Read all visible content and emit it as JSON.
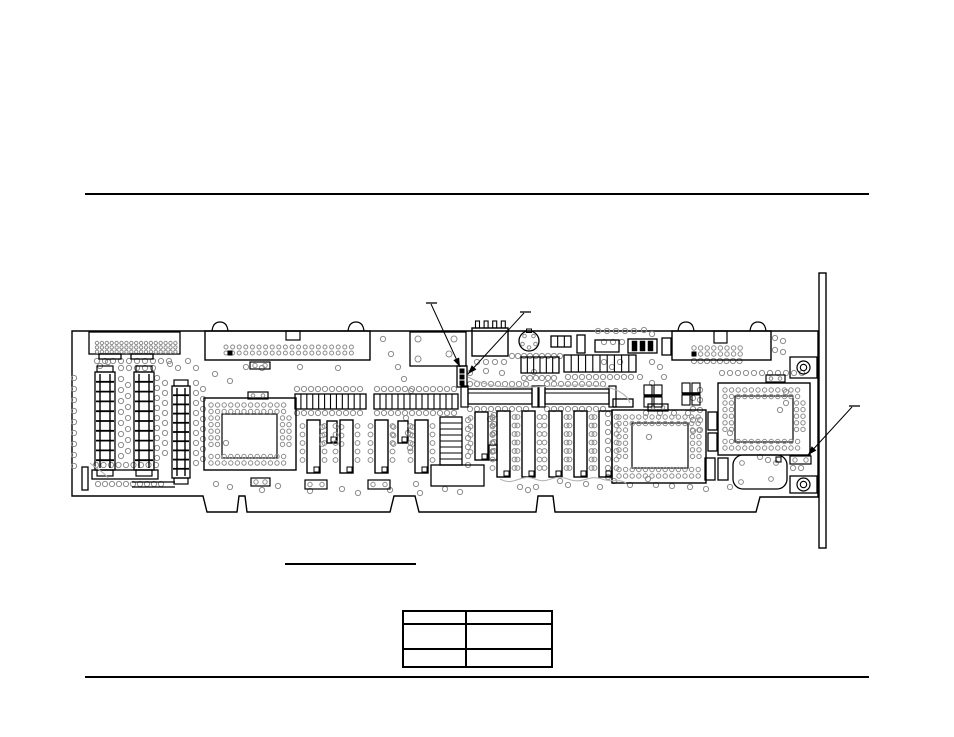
{
  "document": {
    "background": "#ffffff",
    "ink": "#000000",
    "pad_color": "#8c8c8c",
    "arc_color": "#b5b5b5"
  },
  "table": {
    "rows": [
      [
        "",
        ""
      ],
      [
        "",
        ""
      ],
      [
        "",
        ""
      ]
    ]
  },
  "board": {
    "outline": "M72,331 L818,331 L818,497 L760,497 L756,512 L555,512 L553,496 L538,496 L536,512 L419,512 L415,496 L394,496 L390,512 L247,512 L245,496 L239,496 L237,512 L207,512 L203,496 L72,496 Z",
    "bracket": {
      "x": 819,
      "y": 273,
      "w": 7,
      "h": 275
    },
    "components": [
      {
        "t": "rect",
        "n": "edge-connector-left",
        "x": 89,
        "y": 332,
        "w": 91,
        "h": 22
      },
      {
        "t": "grid",
        "n": "edge-connector-left-pins",
        "x": 97,
        "y": 343,
        "cols": 17,
        "rows": 3,
        "dx": 4.9,
        "dy": 4.4,
        "r": 1.7
      },
      {
        "t": "rect",
        "n": "connector-tab",
        "x": 99,
        "y": 354,
        "w": 22,
        "h": 5
      },
      {
        "t": "rect",
        "n": "connector-tab",
        "x": 131,
        "y": 354,
        "w": 22,
        "h": 5
      },
      {
        "t": "header",
        "n": "floppy-header-connector",
        "x": 205,
        "y": 331,
        "w": 165,
        "h": 29,
        "notch": [
          286,
          331,
          14,
          9
        ],
        "ears": [
          212,
          348
        ],
        "pins": [
          226,
          347,
          20,
          2,
          6.6,
          6,
          2
        ]
      },
      {
        "t": "rect",
        "n": "relay-component",
        "x": 410,
        "y": 332,
        "w": 56,
        "h": 34
      },
      {
        "t": "dots",
        "n": "relay-pads",
        "r": 3,
        "pts": [
          [
            418,
            339
          ],
          [
            454,
            339
          ],
          [
            418,
            359
          ],
          [
            449,
            354
          ]
        ]
      },
      {
        "t": "power",
        "n": "power-connector",
        "x": 472,
        "y": 328,
        "w": 36,
        "h": 28
      },
      {
        "t": "din",
        "n": "keyboard-din-connector",
        "cx": 529,
        "cy": 341,
        "r": 10
      },
      {
        "t": "header",
        "n": "aux-header-connector",
        "x": 672,
        "y": 331,
        "w": 99,
        "h": 29,
        "notch": [
          714,
          331,
          13,
          12
        ],
        "ears": [
          678,
          750
        ],
        "pins": [
          694,
          348,
          8,
          2,
          6.6,
          6,
          2.2
        ]
      },
      {
        "t": "mount",
        "n": "mounting-hole-top",
        "x": 790,
        "y": 357,
        "w": 27,
        "h": 21
      },
      {
        "t": "mount",
        "n": "mounting-hole-bottom",
        "x": 790,
        "y": 476,
        "w": 27,
        "h": 17
      },
      {
        "t": "simmv",
        "n": "memory-socket-1",
        "x": 95,
        "y": 372,
        "w": 20,
        "h": 98,
        "rungs": 9
      },
      {
        "t": "simmv",
        "n": "memory-socket-2",
        "x": 134,
        "y": 372,
        "w": 20,
        "h": 98,
        "rungs": 9
      },
      {
        "t": "simmv",
        "n": "memory-socket-3",
        "x": 172,
        "y": 386,
        "w": 18,
        "h": 92,
        "rungs": 9
      },
      {
        "t": "rect",
        "n": "bottom-left-connector",
        "x": 92,
        "y": 470,
        "w": 66,
        "h": 9
      },
      {
        "t": "rect",
        "n": "small-ic",
        "x": 82,
        "y": 467,
        "w": 6,
        "h": 23
      },
      {
        "t": "line",
        "n": "silkscreen-line",
        "p": [
          132,
          482,
          175,
          482
        ]
      },
      {
        "t": "line",
        "n": "silkscreen-line",
        "p": [
          132,
          487,
          175,
          487
        ]
      },
      {
        "t": "pga",
        "n": "pga-chip-left",
        "x": 204,
        "y": 398,
        "w": 92,
        "h": 72,
        "inner": [
          222,
          414,
          55,
          44
        ],
        "cap": [
          248,
          392,
          20,
          7
        ]
      },
      {
        "t": "comb",
        "n": "resistor-pack",
        "x": 295,
        "y": 394,
        "w": 71,
        "h": 15,
        "bars": 11
      },
      {
        "t": "comb",
        "n": "resistor-pack",
        "x": 374,
        "y": 394,
        "w": 84,
        "h": 15,
        "bars": 13
      },
      {
        "t": "dip",
        "n": "dip-chip",
        "x": 307,
        "y": 420,
        "w": 13,
        "h": 53
      },
      {
        "t": "dip",
        "n": "dip-chip-small",
        "x": 327,
        "y": 421,
        "w": 10,
        "h": 22
      },
      {
        "t": "dip",
        "n": "dip-chip",
        "x": 340,
        "y": 420,
        "w": 13,
        "h": 53
      },
      {
        "t": "dip",
        "n": "dip-chip",
        "x": 375,
        "y": 420,
        "w": 13,
        "h": 53
      },
      {
        "t": "dip",
        "n": "dip-chip-small",
        "x": 398,
        "y": 421,
        "w": 10,
        "h": 22
      },
      {
        "t": "dip",
        "n": "dip-chip",
        "x": 415,
        "y": 420,
        "w": 13,
        "h": 53
      },
      {
        "t": "sip",
        "n": "sip-resistor-network",
        "x": 440,
        "y": 417,
        "w": 22,
        "h": 48,
        "rungs": 7
      },
      {
        "t": "dip",
        "n": "dip-chip",
        "x": 475,
        "y": 412,
        "w": 13,
        "h": 48
      },
      {
        "t": "rect",
        "n": "small-ic",
        "x": 489,
        "y": 445,
        "w": 8,
        "h": 15
      },
      {
        "t": "rect",
        "n": "crystal-oscillator",
        "x": 431,
        "y": 465,
        "w": 53,
        "h": 21
      },
      {
        "t": "pads2",
        "n": "jumper-pads",
        "x": 251,
        "y": 478,
        "w": 19,
        "h": 8
      },
      {
        "t": "pads2",
        "n": "jumper-pads",
        "x": 250,
        "y": 362,
        "w": 20,
        "h": 7
      },
      {
        "t": "pads2",
        "n": "jumper-pads",
        "x": 305,
        "y": 480,
        "w": 22,
        "h": 9
      },
      {
        "t": "pads2",
        "n": "jumper-pads",
        "x": 368,
        "y": 480,
        "w": 22,
        "h": 9
      },
      {
        "t": "jumper3",
        "n": "config-jumper",
        "x": 457,
        "y": 366,
        "w": 10,
        "h": 21
      },
      {
        "t": "simmh",
        "n": "sipp-socket-1",
        "x": 468,
        "y": 389,
        "w": 64,
        "h": 15
      },
      {
        "t": "simmh",
        "n": "sipp-socket-2",
        "x": 545,
        "y": 389,
        "w": 64,
        "h": 15
      },
      {
        "t": "dip",
        "n": "dram-chip",
        "x": 497,
        "y": 411,
        "w": 13,
        "h": 66
      },
      {
        "t": "dip",
        "n": "dram-chip",
        "x": 522,
        "y": 411,
        "w": 13,
        "h": 66
      },
      {
        "t": "dip",
        "n": "dram-chip",
        "x": 549,
        "y": 411,
        "w": 13,
        "h": 66
      },
      {
        "t": "dip",
        "n": "dram-chip",
        "x": 574,
        "y": 411,
        "w": 13,
        "h": 66
      },
      {
        "t": "dip",
        "n": "dram-chip",
        "x": 599,
        "y": 411,
        "w": 13,
        "h": 66
      },
      {
        "t": "rect",
        "n": "small-ic",
        "x": 613,
        "y": 399,
        "w": 20,
        "h": 8
      },
      {
        "t": "pga",
        "n": "pga-chip-center",
        "x": 612,
        "y": 410,
        "w": 94,
        "h": 73,
        "inner": [
          632,
          423,
          56,
          45
        ],
        "cap": [
          648,
          404,
          20,
          7
        ]
      },
      {
        "t": "pga",
        "n": "pga-chip-right",
        "x": 718,
        "y": 383,
        "w": 92,
        "h": 72,
        "inner": [
          735,
          396,
          58,
          46
        ],
        "cap": [
          766,
          375,
          19,
          7
        ]
      },
      {
        "t": "rect",
        "n": "small-ic",
        "x": 708,
        "y": 412,
        "w": 9,
        "h": 18
      },
      {
        "t": "rect",
        "n": "small-ic",
        "x": 708,
        "y": 433,
        "w": 9,
        "h": 18
      },
      {
        "t": "rect",
        "n": "small-ic",
        "x": 705,
        "y": 458,
        "w": 10,
        "h": 22
      },
      {
        "t": "rect",
        "n": "small-ic",
        "x": 718,
        "y": 458,
        "w": 10,
        "h": 22
      },
      {
        "t": "round",
        "n": "oscillator-can",
        "x": 733,
        "y": 455,
        "w": 54,
        "h": 34,
        "rx": 10,
        "dots": [
          [
            742,
            463
          ],
          [
            776,
            463
          ],
          [
            741,
            482
          ],
          [
            771,
            479
          ]
        ],
        "sq": [
          776,
          457,
          5,
          5
        ]
      },
      {
        "t": "pads2",
        "n": "jumper-pads-right",
        "x": 790,
        "y": 456,
        "w": 21,
        "h": 8
      },
      {
        "t": "dots",
        "n": "via-pair",
        "r": 2.6,
        "pts": [
          [
            793,
            468
          ],
          [
            801,
            468
          ]
        ]
      },
      {
        "t": "cappair",
        "n": "capacitor-pair",
        "x": 644,
        "y": 385
      },
      {
        "t": "cappair",
        "n": "capacitor-pair",
        "x": 682,
        "y": 383
      },
      {
        "t": "comb",
        "n": "small-component",
        "x": 551,
        "y": 336,
        "w": 20,
        "h": 11,
        "bars": 2
      },
      {
        "t": "rect",
        "n": "small-ic",
        "x": 577,
        "y": 335,
        "w": 8,
        "h": 18
      },
      {
        "t": "rect",
        "n": "small-ic",
        "x": 595,
        "y": 340,
        "w": 24,
        "h": 12
      },
      {
        "t": "blackbars",
        "n": "component-array",
        "x": 628,
        "y": 339,
        "w": 29,
        "h": 14,
        "bars": 3
      },
      {
        "t": "rect",
        "n": "small-ic",
        "x": 662,
        "y": 338,
        "w": 9,
        "h": 17
      },
      {
        "t": "comb",
        "n": "resistor-pack",
        "x": 521,
        "y": 357,
        "w": 38,
        "h": 16,
        "bars": 5
      },
      {
        "t": "comb",
        "n": "resistor-pack",
        "x": 564,
        "y": 355,
        "w": 72,
        "h": 17,
        "bars": 9
      },
      {
        "t": "sq",
        "n": "pin1-mark",
        "x": 228,
        "y": 351,
        "w": 4,
        "h": 4
      },
      {
        "t": "sq",
        "n": "pin1-mark",
        "x": 692,
        "y": 352,
        "w": 4,
        "h": 4
      }
    ],
    "via_rows": [
      [
        97,
        361,
        10,
        8,
        0
      ],
      [
        121,
        368,
        5,
        8,
        0
      ],
      [
        74,
        378,
        9,
        0,
        11
      ],
      [
        121,
        379,
        8,
        0,
        11
      ],
      [
        128,
        385,
        7,
        0,
        11
      ],
      [
        157,
        378,
        9,
        0,
        10
      ],
      [
        165,
        383,
        8,
        0,
        10
      ],
      [
        196,
        383,
        9,
        0,
        10
      ],
      [
        203,
        389,
        8,
        0,
        10
      ],
      [
        96,
        465,
        9,
        7.5,
        0
      ],
      [
        98,
        484,
        10,
        7,
        0
      ],
      [
        297,
        389,
        10,
        7,
        0
      ],
      [
        297,
        413,
        10,
        7,
        0
      ],
      [
        377,
        389,
        12,
        7,
        0
      ],
      [
        377,
        413,
        12,
        7,
        0
      ],
      [
        470,
        384,
        9,
        7,
        0
      ],
      [
        470,
        409,
        9,
        7,
        0
      ],
      [
        547,
        384,
        9,
        7,
        0
      ],
      [
        547,
        409,
        9,
        7,
        0
      ],
      [
        512,
        356,
        9,
        6,
        0
      ],
      [
        524,
        378,
        6,
        6,
        0
      ],
      [
        568,
        377,
        10,
        7,
        0
      ],
      [
        598,
        331,
        5,
        9,
        0
      ],
      [
        604,
        342,
        3,
        9,
        0
      ],
      [
        694,
        361,
        8,
        6.5,
        0
      ],
      [
        722,
        373,
        11,
        8,
        0
      ],
      [
        468,
        420,
        6,
        0,
        9
      ],
      [
        494,
        415,
        5,
        0,
        9
      ],
      [
        608,
        414,
        8,
        0,
        9
      ],
      [
        700,
        390,
        5,
        0,
        10
      ],
      [
        693,
        398,
        4,
        0,
        11
      ],
      [
        477,
        362,
        4,
        9,
        0
      ]
    ],
    "via_dots": [
      [
        188,
        361
      ],
      [
        196,
        368
      ],
      [
        215,
        374
      ],
      [
        230,
        381
      ],
      [
        246,
        367
      ],
      [
        262,
        368
      ],
      [
        300,
        367
      ],
      [
        338,
        368
      ],
      [
        383,
        339
      ],
      [
        391,
        354
      ],
      [
        398,
        367
      ],
      [
        404,
        379
      ],
      [
        411,
        391
      ],
      [
        406,
        418
      ],
      [
        408,
        433
      ],
      [
        410,
        448
      ],
      [
        490,
        419
      ],
      [
        416,
        484
      ],
      [
        445,
        489
      ],
      [
        460,
        492
      ],
      [
        216,
        484
      ],
      [
        230,
        487
      ],
      [
        262,
        490
      ],
      [
        278,
        486
      ],
      [
        310,
        491
      ],
      [
        342,
        489
      ],
      [
        358,
        493
      ],
      [
        390,
        490
      ],
      [
        420,
        493
      ],
      [
        520,
        487
      ],
      [
        528,
        490
      ],
      [
        536,
        487
      ],
      [
        560,
        481
      ],
      [
        568,
        485
      ],
      [
        586,
        484
      ],
      [
        600,
        487
      ],
      [
        614,
        481
      ],
      [
        630,
        485
      ],
      [
        648,
        479
      ],
      [
        656,
        485
      ],
      [
        672,
        486
      ],
      [
        690,
        487
      ],
      [
        706,
        489
      ],
      [
        730,
        487
      ],
      [
        646,
        413
      ],
      [
        660,
        413
      ],
      [
        674,
        413
      ],
      [
        688,
        413
      ],
      [
        786,
        392
      ],
      [
        786,
        403
      ],
      [
        780,
        410
      ],
      [
        760,
        457
      ],
      [
        768,
        460
      ],
      [
        775,
        338
      ],
      [
        783,
        341
      ],
      [
        775,
        350
      ],
      [
        783,
        352
      ],
      [
        640,
        377
      ],
      [
        652,
        383
      ],
      [
        664,
        377
      ],
      [
        604,
        362
      ],
      [
        612,
        367
      ],
      [
        620,
        362
      ],
      [
        652,
        362
      ],
      [
        660,
        367
      ],
      [
        170,
        364
      ],
      [
        178,
        368
      ],
      [
        108,
        362
      ],
      [
        100,
        366
      ],
      [
        644,
        330
      ],
      [
        652,
        334
      ],
      [
        470,
        373
      ],
      [
        486,
        371
      ],
      [
        502,
        373
      ],
      [
        534,
        372
      ],
      [
        226,
        443
      ],
      [
        649,
        437
      ],
      [
        730,
        433
      ]
    ],
    "arcs": [
      "M468,377 C505,397 555,381 600,386 C616,388 627,394 630,403",
      "M500,479 C515,487 520,473 535,479 C550,485 552,473 568,479 C584,485 588,474 602,479 C612,483 618,478 626,483",
      "M90,463 C98,470 104,472 108,478"
    ],
    "leaders": [
      {
        "tick": [
          426,
          303,
          437,
          303
        ],
        "line": [
          431,
          304,
          460,
          367
        ]
      },
      {
        "tick": [
          520,
          312,
          531,
          312
        ],
        "line": [
          524,
          313,
          468,
          374
        ]
      },
      {
        "tick": [
          849,
          406,
          860,
          406
        ],
        "line": [
          852,
          407,
          808,
          455
        ]
      }
    ]
  }
}
